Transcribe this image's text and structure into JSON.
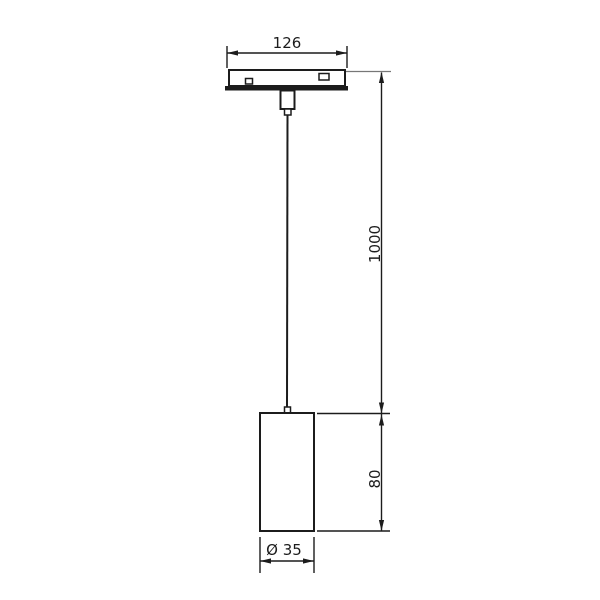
{
  "drawing": {
    "kind": "technical-dimension-diagram",
    "subject": "pendant track light fixture with suspension cable",
    "labels": {
      "track_width": "126",
      "cable_length": "1000",
      "lamp_height": "80",
      "lamp_diameter": "Ø 35"
    },
    "colors": {
      "line": "#1c1c1c",
      "background": "#ffffff"
    }
  }
}
